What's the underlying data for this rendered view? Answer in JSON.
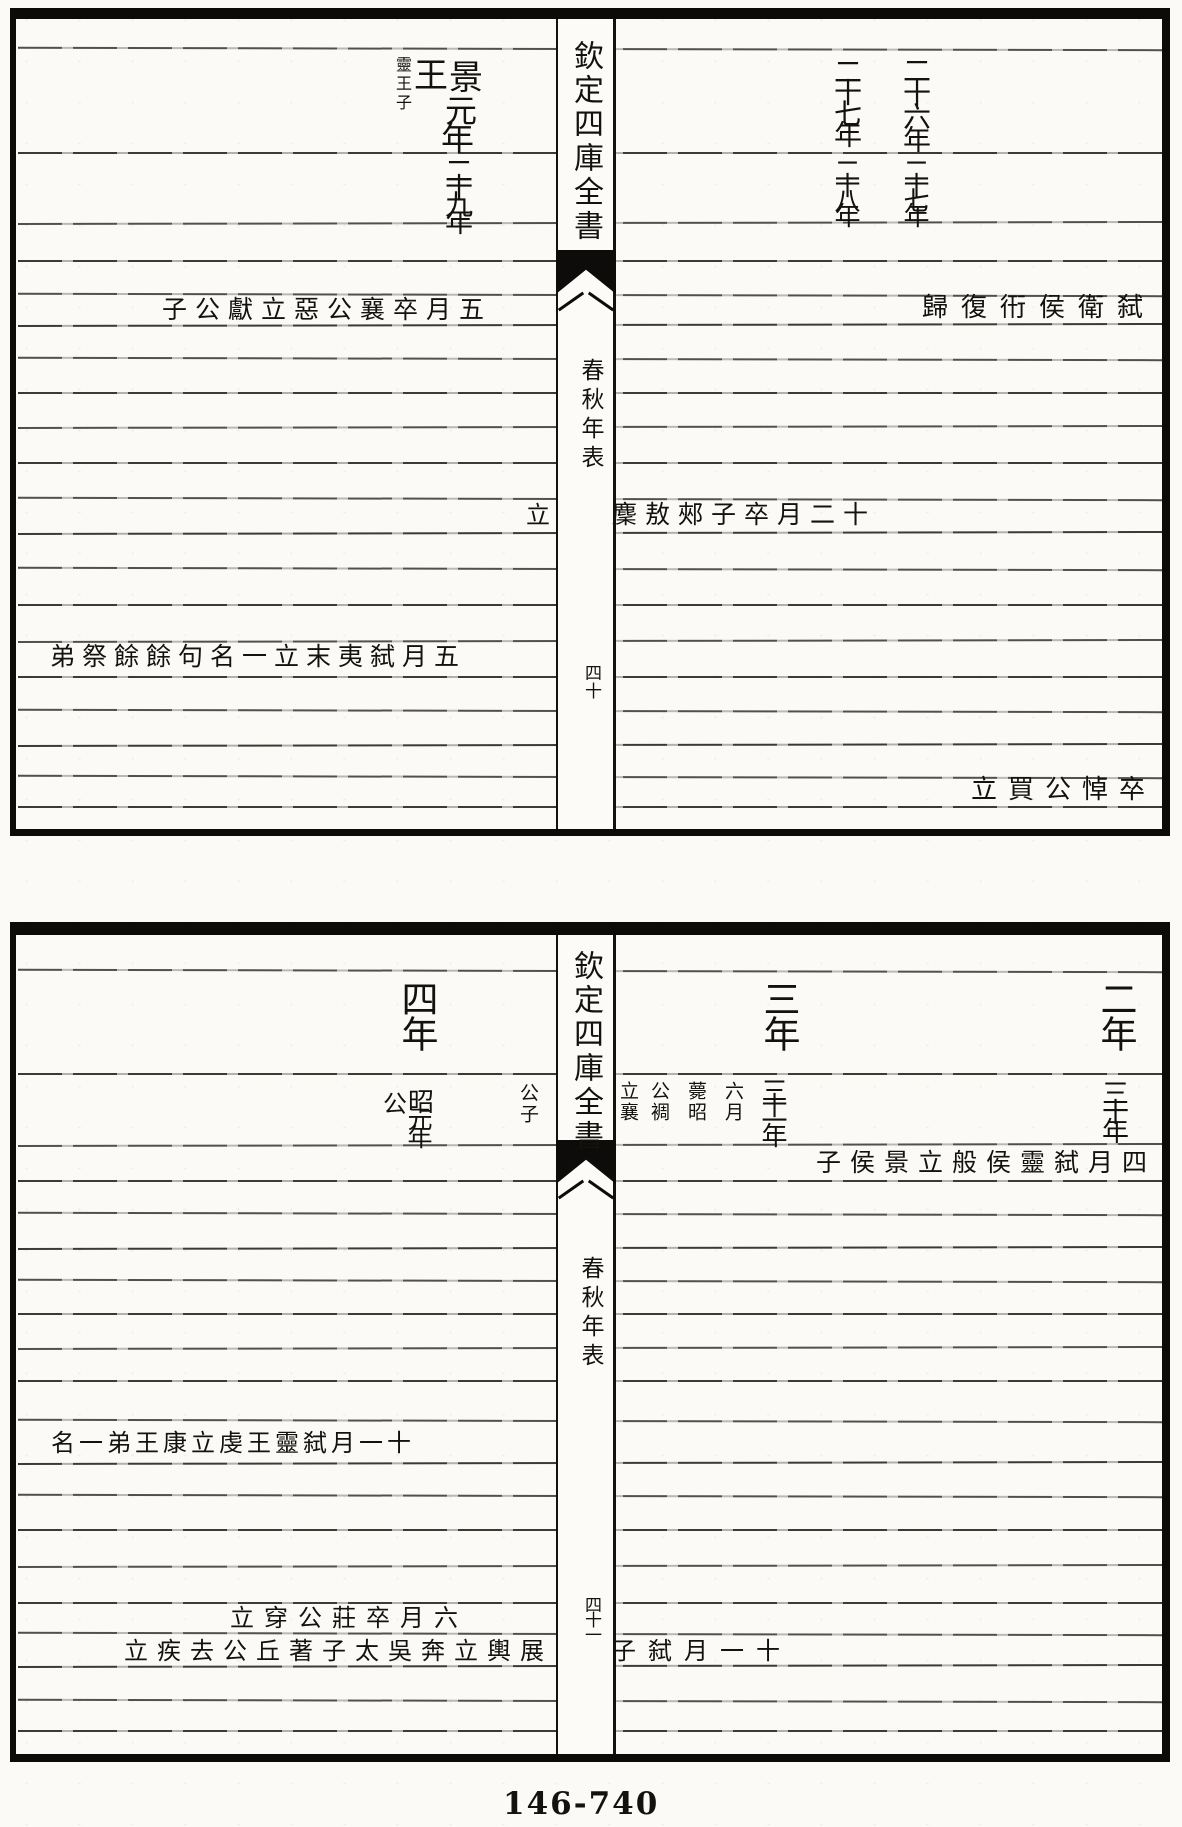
{
  "page": {
    "footer_number": "146-740"
  },
  "leaf1": {
    "spine": {
      "title": "欽定四庫全書",
      "section": "春秋年表",
      "folio": "四十"
    },
    "zhou_year": {
      "jing": "景",
      "wang": "王",
      "yuan": "元",
      "nian": "年",
      "note": "靈王子"
    },
    "lu_year_left": "二十九年",
    "right_years": {
      "c1r1": "二十六年",
      "c2r1": "二十七年",
      "c1r2": "二十七年",
      "c2r2": "二十八年"
    },
    "entries": {
      "wei_left": "五月卒襄公惡立獻公子",
      "wei_right": "弑衛侯衎復歸",
      "chu_left": "立",
      "chu_right": "十二月卒子郟敖麇",
      "wu_left": "五月弑夷末立一名句餘餘祭弟",
      "xu_right": "卒悼公買立"
    }
  },
  "leaf2": {
    "spine": {
      "title": "欽定四庫全書",
      "section": "春秋年表",
      "folio": "四十一"
    },
    "years": {
      "y4": "四年",
      "y3": "三年",
      "y2": "二年"
    },
    "lu_row": {
      "zhao": "昭",
      "gong": "公",
      "era": "元年",
      "note_left": "公子",
      "note_cols": [
        "六月",
        "薨昭",
        "公裯",
        "立襄"
      ],
      "year_under_three": "三十一年",
      "year_under_two": "三十年"
    },
    "entries": {
      "cai": "四月弑靈侯般立景侯子",
      "chu": "十一月弑靈王虔立康王弟一名",
      "zhu": "六月卒莊公穿立",
      "ju_left": "展輿立奔吳太子著丘公去疾立",
      "ju_right": "十一月弑子"
    }
  }
}
